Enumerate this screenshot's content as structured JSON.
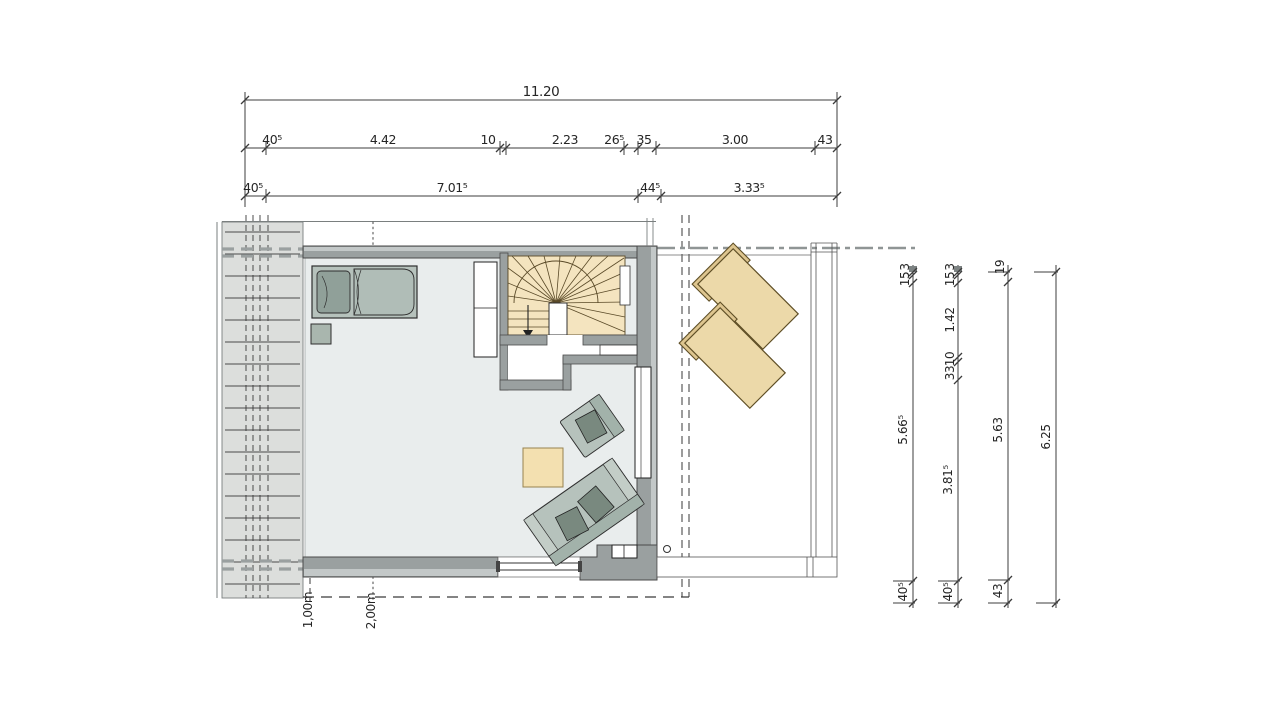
{
  "dims": {
    "top_total": "11.20",
    "top_row2": [
      "40⁵",
      "4.42",
      "10",
      "2.23",
      "26⁵",
      "35",
      "3.00",
      "43"
    ],
    "top_row3": [
      "40⁵",
      "7.01⁵",
      "44⁵",
      "3.33⁵"
    ],
    "right_col1": [
      "3",
      "15",
      "5.66⁵",
      "40⁵"
    ],
    "right_col2": [
      "3",
      "15",
      "1.42",
      "10",
      "33",
      "3.81⁵",
      "40⁵"
    ],
    "right_col3": [
      "19",
      "5.63",
      "43"
    ],
    "right_col4": [
      "6.25"
    ],
    "height_marks": [
      "1,00m",
      "2,00m"
    ]
  },
  "colors": {
    "wall": "#9aa0a0",
    "wall_light": "#c3c8c8",
    "floor": "#e9eded",
    "roof_strip": "#dcdedc",
    "stairs": "#f4e4bf",
    "rug": "#f3e0b0",
    "lounger": "#ecd9a9",
    "furniture": "#b6c2bc",
    "cushion": "#79897f",
    "line": "#3c3c3c"
  }
}
